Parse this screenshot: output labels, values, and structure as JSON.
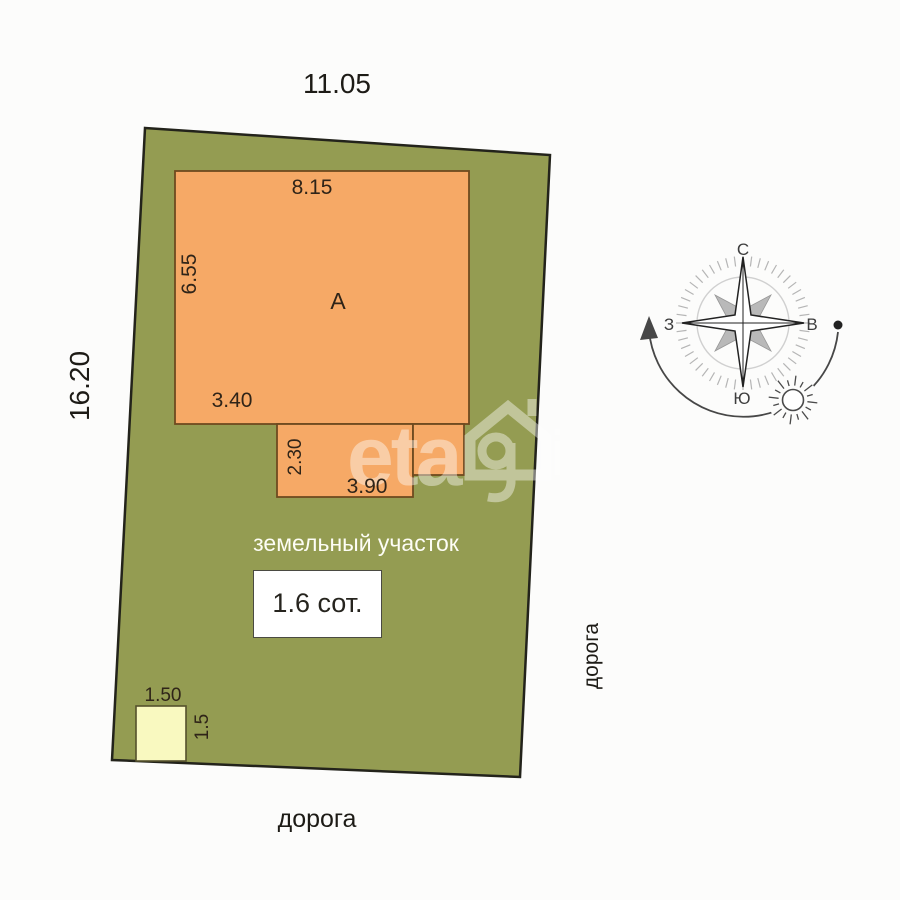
{
  "dimensions": {
    "plot_top": "11.05",
    "plot_left": "16.20",
    "building_top": "8.15",
    "building_left": "6.55",
    "building_bottom_left": "3.40",
    "annex_height": "2.30",
    "annex_width": "3.90",
    "shed_width": "1.50",
    "shed_height": "1.5"
  },
  "labels": {
    "building": "А",
    "plot": "земельный участок",
    "area": "1.6 сот.",
    "road_bottom": "дорога",
    "road_right": "дорога"
  },
  "compass": {
    "north": "С",
    "south": "Ю",
    "west": "З",
    "east": "В"
  },
  "watermark": {
    "left_text": "eta",
    "right_text": "i"
  },
  "colors": {
    "plot_fill": "#949c52",
    "plot_stroke": "#23231b",
    "building_fill": "#f6a966",
    "building_stroke": "#6e4a20",
    "shed_fill": "#f9f9c0",
    "shed_stroke": "#55512c",
    "background": "#fcfcfb",
    "compass_gray": "#b9b9b9",
    "text_dark": "#1d1b16"
  }
}
